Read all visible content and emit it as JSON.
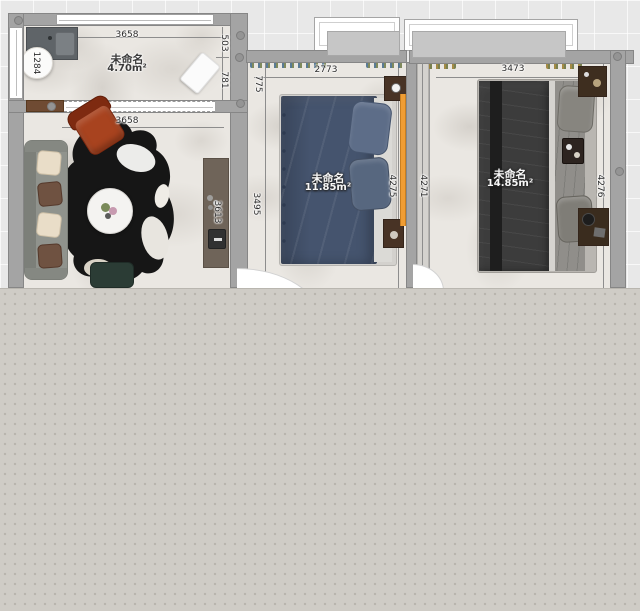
{
  "app": {
    "view": "floor-plan-2d"
  },
  "rooms": {
    "balcony": {
      "name": "未命名",
      "area": "4.70m²",
      "dims": {
        "top": "3658",
        "right_upper": "503",
        "right_lower": "781",
        "left": "1284"
      }
    },
    "living": {
      "dims": {
        "top": "3658",
        "side": "3613"
      }
    },
    "bedroom_mid": {
      "name": "未命名",
      "area": "11.85m²",
      "dims": {
        "top": "2773",
        "left_upper": "775",
        "left": "3495",
        "right_inner": "4275",
        "right_outer": "4271"
      }
    },
    "bedroom_right": {
      "name": "未命名",
      "area": "14.85m²",
      "dims": {
        "top": "3473",
        "right": "4276"
      }
    }
  },
  "palette": {
    "canvas_grid": "#e8e8e8",
    "bottom_overlay": "#cfccc6",
    "wall": "#a4a4a4",
    "floor_marble": "#eae7e2",
    "bed_blue": "#45546e",
    "bed_charcoal": "#3c3c3c",
    "chair_rust": "#a8431f",
    "rug_black": "#161616",
    "ottoman_teal": "#2b3c35",
    "nightstand_wood": "#483325",
    "console_wood": "#6f6459",
    "accent_orange": "#f09d33"
  }
}
